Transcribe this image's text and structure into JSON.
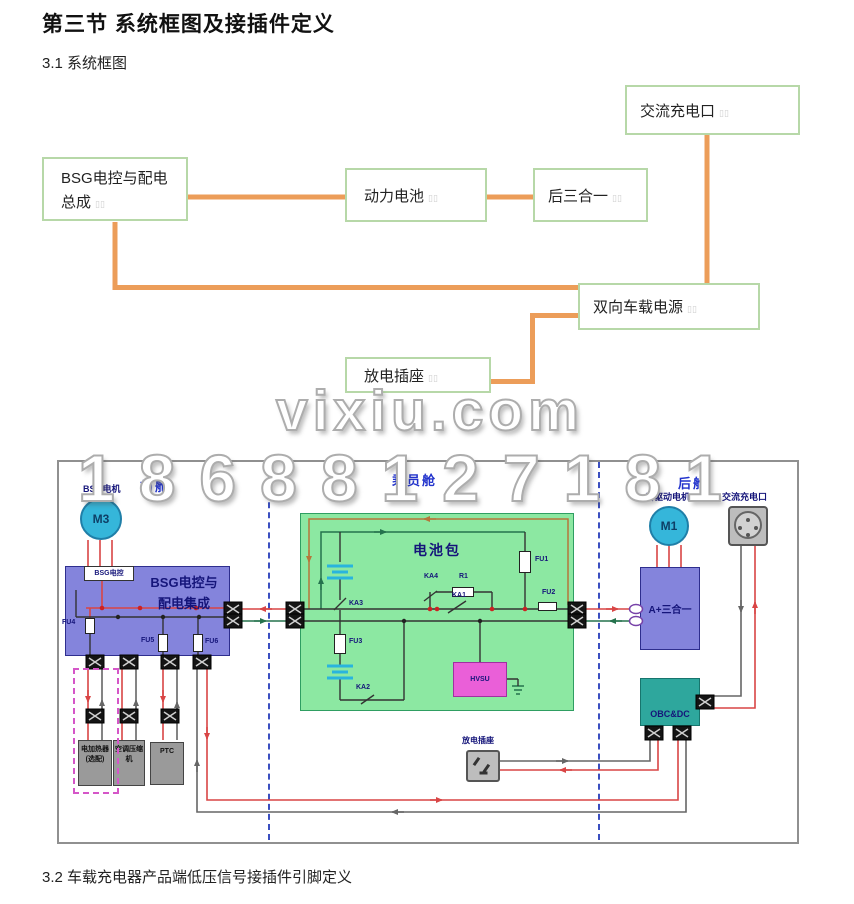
{
  "page": {
    "title": "第三节  系统框图及接插件定义",
    "section_31": "3.1 系统框图",
    "section_32": "3.2 车载充电器产品端低压信号接插件引脚定义"
  },
  "watermark": {
    "site": "vixiu.com",
    "phone": "18688127181"
  },
  "flowchart": {
    "ac_port": "交流充电口",
    "bsg_assembly": "BSG电控与配电总成",
    "traction_battery": "动力电池",
    "rear_three_in_one": "后三合一",
    "bidirectional_obc": "双向车载电源",
    "discharge_socket": "放电插座",
    "line_color": "#EC9D59",
    "box_border_color": "#B7D8A8"
  },
  "diagram": {
    "zone_front": "前舱",
    "zone_cabin": "乘员舱",
    "zone_rear": "后舱",
    "bsg_motor": "BSG电机",
    "m3": "M3",
    "bsg_ctrl": "BSG电控",
    "bsg_title_1": "BSG电控与",
    "bsg_title_2": "配电集成",
    "fu1": "FU1",
    "fu2": "FU2",
    "fu3": "FU3",
    "fu4": "FU4",
    "fu5": "FU5",
    "fu6": "FU6",
    "ka1": "KA1",
    "ka2": "KA2",
    "ka3": "KA3",
    "ka4": "KA4",
    "r1": "R1",
    "battery_pack": "电池包",
    "hvsu": "HVSU",
    "rear_motor": "后驱动电机",
    "m1": "M1",
    "ac_port": "交流充电口",
    "a_three_in_one": "A+三合一",
    "obc_dc": "OBC&DC",
    "discharge_socket": "放电插座",
    "load1_line1": "电加热器",
    "load1_line2": "(选配)",
    "load2_line1": "空调压缩",
    "load2_line2": "机",
    "load3": "PTC",
    "colors": {
      "wire_red": "#D94545",
      "wire_gray": "#666666",
      "wire_green": "#25724D",
      "module_purple": "#8484DC",
      "battery_green": "#8CE8A2",
      "motor_cyan": "#35B6DA",
      "obc_teal": "#2EA79D",
      "hvsu_pink": "#EA5FD8",
      "divider_blue": "#3B4FC0"
    }
  }
}
